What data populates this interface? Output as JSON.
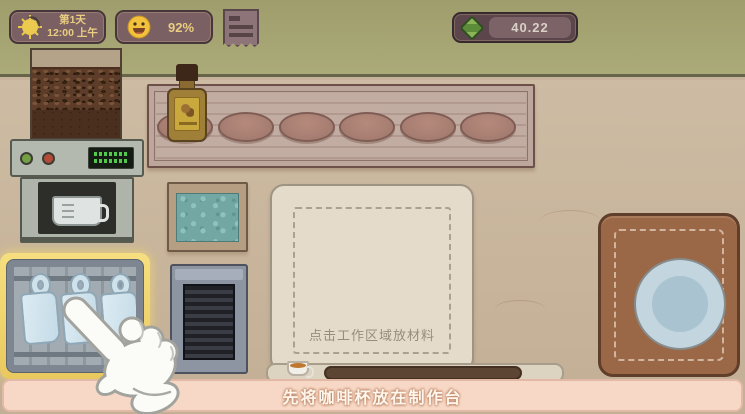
{
  "hud": {
    "clock": {
      "day": "第1天",
      "time": "12:00 上午",
      "icon": "sun-moon-icon"
    },
    "mood": {
      "value": "92%",
      "icon": "smiley-face-icon"
    },
    "orders": {
      "icon": "receipt-icon"
    },
    "money": {
      "value": "40.22",
      "icon": "cash-icon"
    }
  },
  "station": {
    "work_area_hint": "点击工作区域放材料",
    "equipment": [
      "coffee-machine",
      "bean-hopper",
      "syrup-bottle",
      "shelf-plates",
      "ice-bin",
      "vent",
      "cup-cabinet",
      "serving-mat"
    ],
    "shelf_plate_count": 6,
    "cabinet_cup_count": 3
  },
  "tutorial": {
    "message": "先将咖啡杯放在制作台",
    "target": "cup-cabinet"
  },
  "colors": {
    "wall": "#a5a273",
    "counter": "#c6b29a",
    "highlight_yellow": "#f2d876",
    "banner_pink": "#f7d8c6",
    "money_green": "#6f9c43",
    "badge_brown": "#7b6063"
  }
}
